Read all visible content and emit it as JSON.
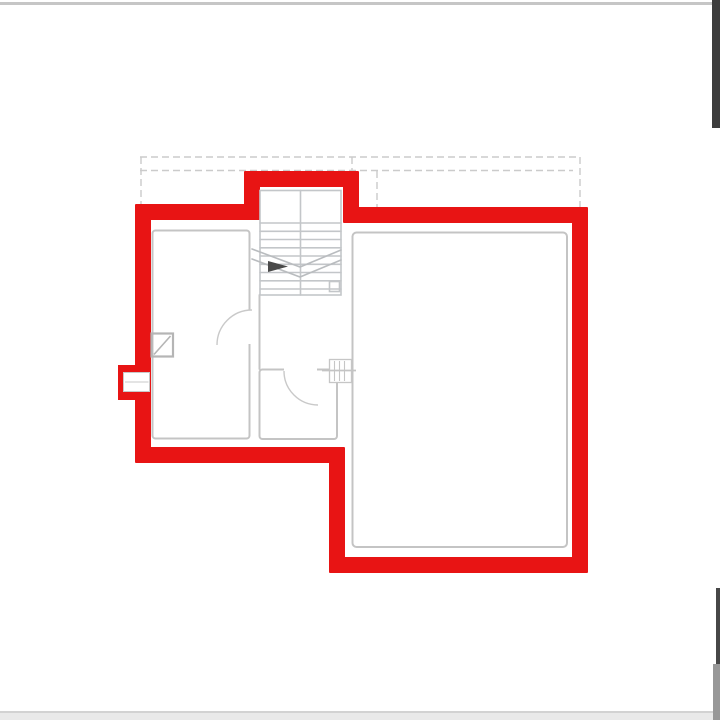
{
  "diagram": {
    "type": "architectural-floor-plan",
    "description": "Floor plan with exterior walls traced in thick red; interior partition walls, double-flight staircase, door swing arcs and a chimney symbol drawn in light gray; dashed setback lines above the plan.",
    "elements": [
      "exterior-wall-red-outline",
      "stair-enclosure-bump-top",
      "left-wall-recess-with-window",
      "left-room",
      "lower-middle-room",
      "large-right-room",
      "staircase-double-flight-with-direction-arrow",
      "door-swing-arc-left-room",
      "door-swing-arc-lower-room",
      "chimney-flue-symbol",
      "hatched-duct-symbol",
      "dashed-construction-lines",
      "scan-edge-artifacts"
    ]
  },
  "colors": {
    "background": "#ffffff",
    "outline_red": "#e81414",
    "wall_gray": "#c4c4c4",
    "stair_gray": "#c3c6c9",
    "break_gray": "#b9bcbf",
    "dashed_gray": "#cbcbcb",
    "light_gray": "#d8d8d8",
    "chimney_gray": "#b5b5b5",
    "arrow_dark": "#4a4a4a",
    "scan_dark": "#3d3d3d",
    "scan_dark2": "#474747",
    "scan_mid": "#989898",
    "scan_strip": "#e9e9e9",
    "scan_strip_edge": "#d2d2d2",
    "scan_top_line": "#c6c6c6",
    "white": "#ffffff"
  }
}
